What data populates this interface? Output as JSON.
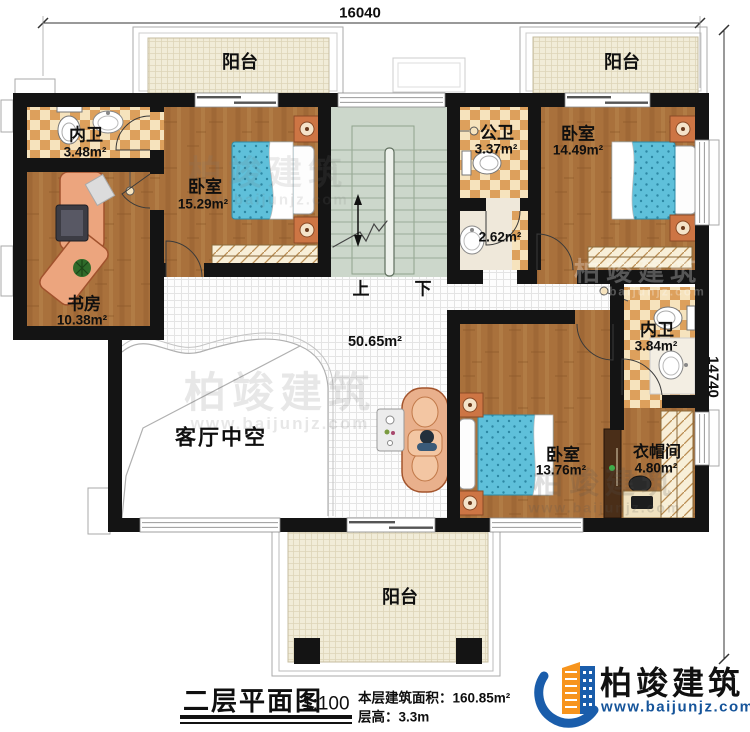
{
  "dimensions": {
    "top": "16040",
    "right": "14740"
  },
  "rooms": {
    "balcony_top_left": {
      "name": "阳台"
    },
    "balcony_top_right": {
      "name": "阳台"
    },
    "balcony_bottom": {
      "name": "阳台"
    },
    "bath_top_left": {
      "name": "内卫",
      "area": "3.48m²"
    },
    "study": {
      "name": "书房",
      "area": "10.38m²"
    },
    "bedroom_top_left": {
      "name": "卧室",
      "area": "15.29m²"
    },
    "public_bath": {
      "name": "公卫",
      "area": "3.37m²"
    },
    "wash_area": {
      "area": "2.62m²"
    },
    "bedroom_top_right": {
      "name": "卧室",
      "area": "14.49m²"
    },
    "bath_right": {
      "name": "内卫",
      "area": "3.84m²"
    },
    "bedroom_bottom": {
      "name": "卧室",
      "area": "13.76m²"
    },
    "cloakroom": {
      "name": "衣帽间",
      "area": "4.80m²"
    },
    "living_void": {
      "name": "客厅中空"
    },
    "hall": {
      "area": "50.65m²"
    }
  },
  "stairs": {
    "up": "上",
    "down": "下"
  },
  "title": {
    "name": "二层平面图",
    "scale": "1:100",
    "building_area": "本层建筑面积：160.85m²",
    "floor_height": "层高：3.3m"
  },
  "branding": {
    "company": "柏竣建筑",
    "website": "www.baijunjz.com"
  },
  "watermark": {
    "company": "柏竣建筑",
    "website": "www.baijunjz.com"
  },
  "colors": {
    "wall": "#141414",
    "wood": "#a9713c",
    "tile": "#dda05c",
    "tile_bg": "#f6e3bd",
    "stairs": "#ccd7cb",
    "bed": "#5fc0da",
    "balcony": "#f1ecd8",
    "logo_blue": "#1a5dab",
    "logo_orange": "#f7941d"
  }
}
